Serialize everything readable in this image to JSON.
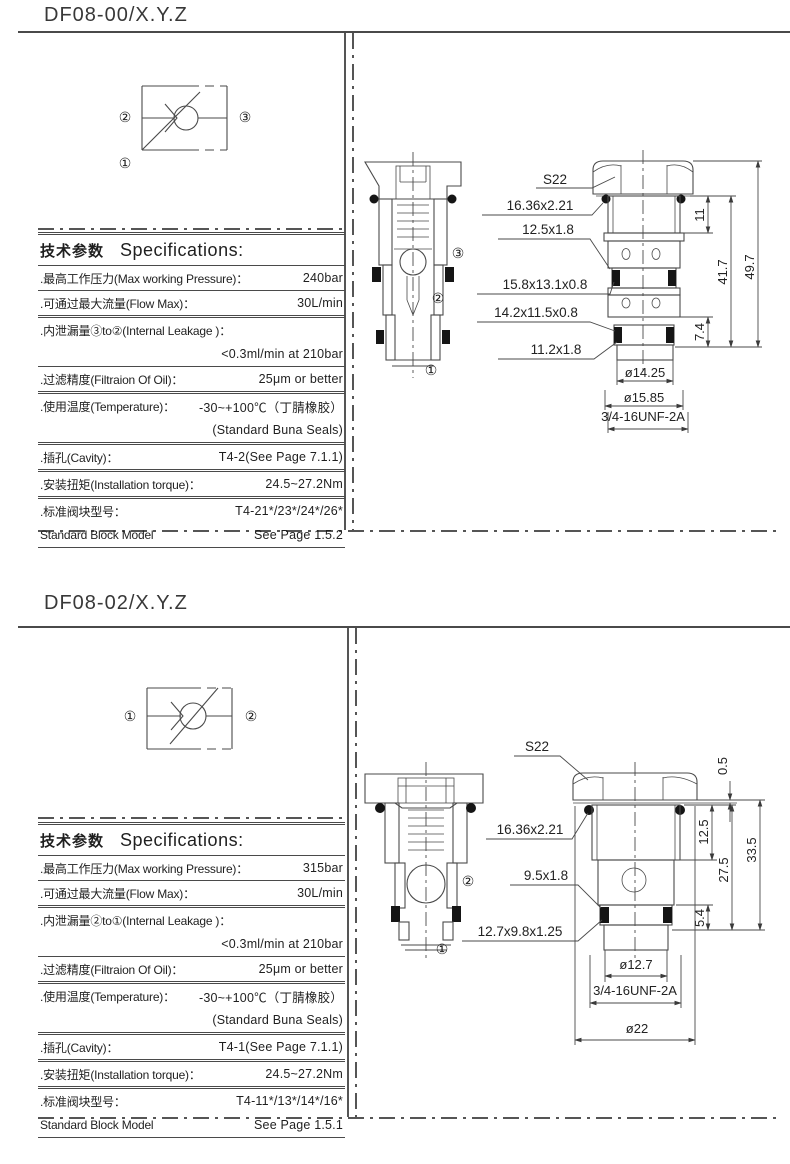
{
  "colors": {
    "line": "#4a4a4a",
    "text": "#1f1f1f",
    "seal": "#151515"
  },
  "s1": {
    "title": "DF08-00/X.Y.Z",
    "symbol": {
      "left": "②",
      "right": "③",
      "corner": "①"
    },
    "table": {
      "header_cn": "技术参数",
      "header_en": "Specifications:",
      "rows": [
        {
          "label": ".最高工作压力(Max working Pressure)：",
          "value": "240bar"
        },
        {
          "label": ".可通过最大流量(Flow Max)：",
          "value": "30L/min"
        },
        {
          "label": ".内泄漏量③to②(Internal Leakage )：",
          "value2": "<0.3ml/min at 210bar"
        },
        {
          "label": ".过滤精度(Filtraion Of Oil)：",
          "value": "25μm or better"
        },
        {
          "label": ".使用温度(Temperature)：",
          "value": "-30~+100℃（丁腈橡胶）",
          "value2": "(Standard Buna Seals)"
        },
        {
          "label": ".插孔(Cavity)：",
          "value": "T4-2(See Page 7.1.1)"
        },
        {
          "label": ".安装扭矩(Installation torque)：",
          "value": "24.5~27.2Nm"
        },
        {
          "label": ".标准阀块型号：",
          "value": "T4-21*/23*/24*/26*",
          "label2": "Standard Block Model",
          "value2": "See Page 1.5.2"
        }
      ]
    },
    "drawing": {
      "ports": {
        "p1": "①",
        "p2": "②",
        "p3": "③"
      },
      "callouts": {
        "s22": "S22",
        "c1": "16.36x2.21",
        "c2": "12.5x1.8",
        "c3": "15.8x13.1x0.8",
        "c4": "14.2x11.5x0.8",
        "c5": "11.2x1.8"
      },
      "dims": {
        "d11": "11",
        "d417": "41.7",
        "d497": "49.7",
        "d74": "7.4",
        "dia1": "ø14.25",
        "dia2": "ø15.85",
        "thread": "3/4-16UNF-2A"
      }
    }
  },
  "s2": {
    "title": "DF08-02/X.Y.Z",
    "symbol": {
      "left": "①",
      "right": "②"
    },
    "table": {
      "header_cn": "技术参数",
      "header_en": "Specifications:",
      "rows": [
        {
          "label": ".最高工作压力(Max working Pressure)：",
          "value": "315bar"
        },
        {
          "label": ".可通过最大流量(Flow Max)：",
          "value": "30L/min"
        },
        {
          "label": ".内泄漏量②to①(Internal Leakage )：",
          "value2": "<0.3ml/min at 210bar"
        },
        {
          "label": ".过滤精度(Filtraion Of Oil)：",
          "value": "25μm or better"
        },
        {
          "label": ".使用温度(Temperature)：",
          "value": "-30~+100℃（丁腈橡胶）",
          "value2": "(Standard Buna Seals)"
        },
        {
          "label": ".插孔(Cavity)：",
          "value": "T4-1(See Page 7.1.1)"
        },
        {
          "label": ".安装扭矩(Installation torque)：",
          "value": "24.5~27.2Nm"
        },
        {
          "label": ".标准阀块型号：",
          "value": "T4-11*/13*/14*/16*",
          "label2": "Standard Block Model",
          "value2": "See Page 1.5.1"
        }
      ]
    },
    "drawing": {
      "ports": {
        "p1": "①",
        "p2": "②"
      },
      "callouts": {
        "s22": "S22",
        "c1": "16.36x2.21",
        "c2": "9.5x1.8",
        "c3": "12.7x9.8x1.25"
      },
      "dims": {
        "d05": "0.5",
        "d125": "12.5",
        "d275": "27.5",
        "d335": "33.5",
        "d54": "5.4",
        "dia1": "ø12.7",
        "thread": "3/4-16UNF-2A",
        "dia22": "ø22"
      }
    }
  }
}
